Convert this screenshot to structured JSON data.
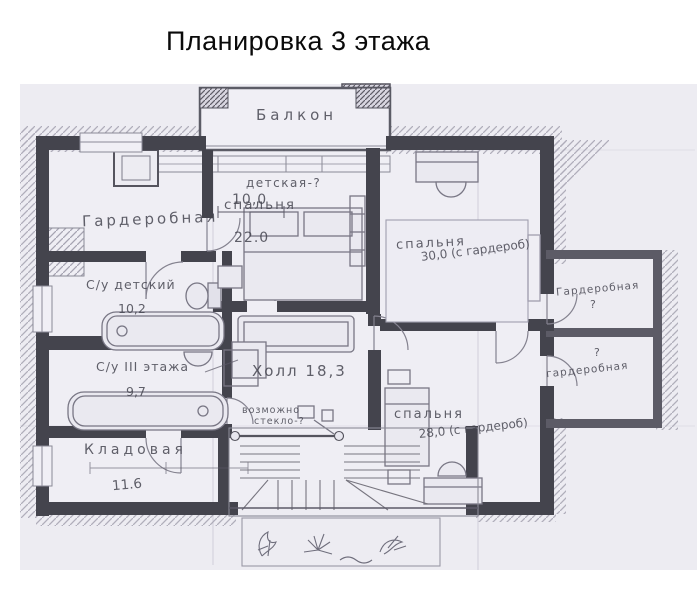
{
  "title": "Планировка 3 этажа",
  "colors": {
    "paper": "#edecf2",
    "wall": "#44444d",
    "pencil": "#82808e",
    "handwriting": "#44444f"
  },
  "labels": {
    "balcony": "Балкон",
    "dim_width": "10,0",
    "wardrobe_tl": "Гардеробная",
    "nursery": {
      "tag": "детская-?",
      "name": "спальня",
      "area": "22.0"
    },
    "bedroom_tr": {
      "name": "спальня",
      "area": "30,0 (с гардероб)"
    },
    "wing_upper": {
      "name": "Гардеробная",
      "mark": "?"
    },
    "wing_lower": {
      "mark": "?",
      "name": "гардеробная"
    },
    "bath_kids": {
      "name": "С/у детский",
      "area": "10,2"
    },
    "bath_floor": {
      "name": "С/у III этажа",
      "area": "9,7"
    },
    "hall": {
      "name": "Холл",
      "area": "18,3"
    },
    "glass_note": {
      "line1": "возможно",
      "line2": "стекло-?"
    },
    "bedroom_br": {
      "name": "спальня",
      "area": "28,0 (с гардероб)"
    },
    "storage": {
      "name": "Кладовая",
      "area": "11.6"
    }
  }
}
